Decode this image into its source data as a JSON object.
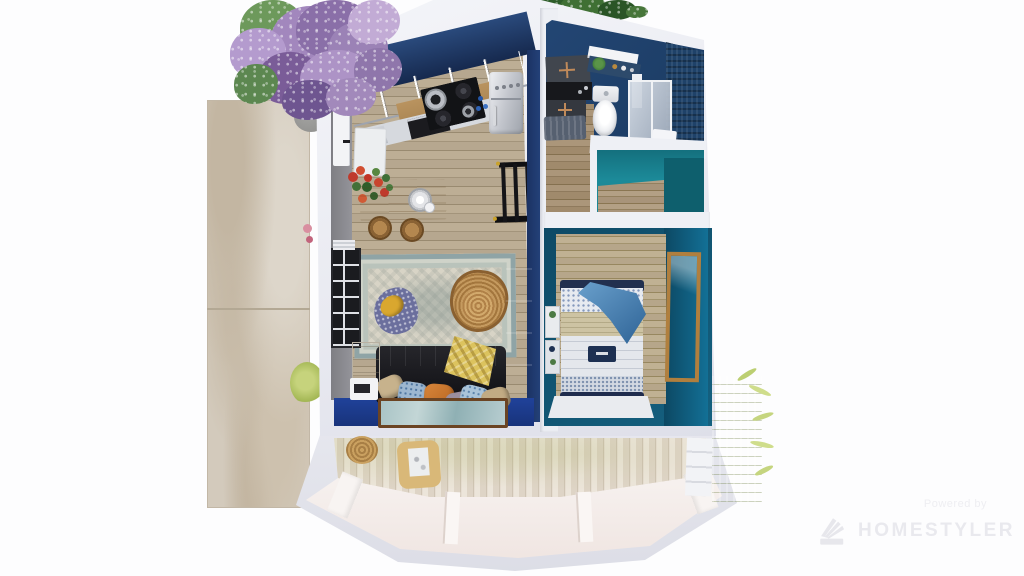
{
  "watermark": {
    "powered_by": "Powered by",
    "brand": "HOMESTYLER",
    "logo_icon": "fan-logo-icon"
  },
  "palette": {
    "exterior_wall": "#eef0f5",
    "kitchen_wall_navy": "#1c3765",
    "living_floor_blue": "#1d3e8e",
    "bedroom_teal": "#14516e",
    "closet_teal": "#1b8795",
    "wood_floor": "#b3a48c",
    "deck_whitewash": "#e7e0d5",
    "stone_path": "#d2c9ba",
    "sofa_black": "#17171a",
    "rattan_tan": "#b9894f",
    "bed_throw_blue": "#3f7fb5",
    "tree_purple": "#a287bd",
    "bamboo_green": "#adc05c"
  }
}
